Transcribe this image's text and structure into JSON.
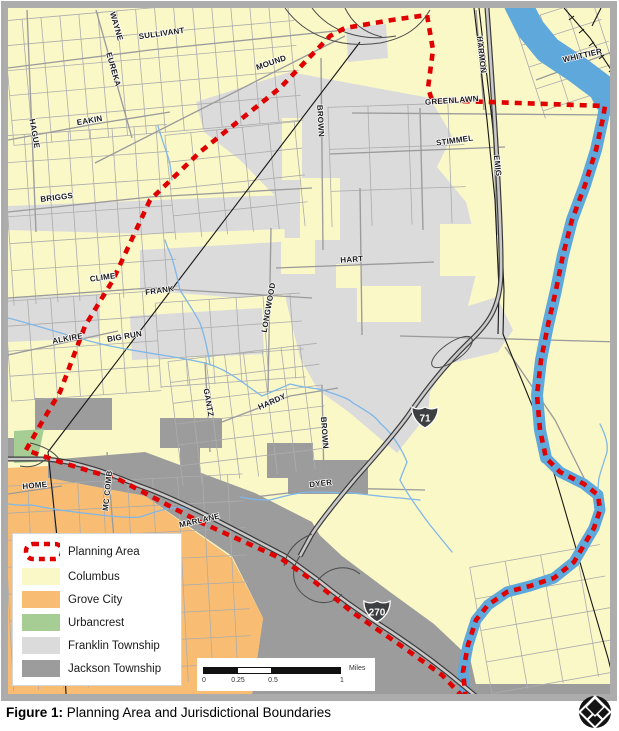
{
  "figure": {
    "label": "Figure 1:",
    "title": "Planning Area and Jurisdictional Boundaries"
  },
  "legend": {
    "items": [
      {
        "label": "Planning Area",
        "swatch": "planning_area"
      },
      {
        "label": "Columbus",
        "swatch": "columbus"
      },
      {
        "label": "Grove City",
        "swatch": "grove_city"
      },
      {
        "label": "Urbancrest",
        "swatch": "urbancrest"
      },
      {
        "label": "Franklin Township",
        "swatch": "franklin_township"
      },
      {
        "label": "Jackson Township",
        "swatch": "jackson_township"
      }
    ]
  },
  "scalebar": {
    "tick0": "0",
    "tick1": "0.25",
    "tick2": "0.5",
    "tick3": "1",
    "unit": "Miles"
  },
  "highways": [
    {
      "route": "71",
      "x": 425,
      "y": 417
    },
    {
      "route": "270",
      "x": 377,
      "y": 611
    }
  ],
  "map": {
    "street_labels": [
      {
        "text": "WAYNE",
        "x": 114,
        "y": 27,
        "rot": 74
      },
      {
        "text": "SULLIVANT",
        "x": 162,
        "y": 36,
        "rot": -8
      },
      {
        "text": "EUREKA",
        "x": 111,
        "y": 70,
        "rot": 74
      },
      {
        "text": "MOUND",
        "x": 272,
        "y": 65,
        "rot": -19
      },
      {
        "text": "HAGUE",
        "x": 32,
        "y": 134,
        "rot": 80
      },
      {
        "text": "EAKIN",
        "x": 90,
        "y": 123,
        "rot": -10
      },
      {
        "text": "BRIGGS",
        "x": 57,
        "y": 200,
        "rot": -7
      },
      {
        "text": "BROWN",
        "x": 318,
        "y": 121,
        "rot": 87
      },
      {
        "text": "HARMON",
        "x": 479,
        "y": 55,
        "rot": 84
      },
      {
        "text": "WHITTIER",
        "x": 583,
        "y": 58,
        "rot": -13
      },
      {
        "text": "GREENLAWN",
        "x": 452,
        "y": 103,
        "rot": -4
      },
      {
        "text": "STIMMEL",
        "x": 455,
        "y": 143,
        "rot": -8
      },
      {
        "text": "EMIG",
        "x": 495,
        "y": 166,
        "rot": 84
      },
      {
        "text": "HART",
        "x": 352,
        "y": 262,
        "rot": -4
      },
      {
        "text": "CLIME",
        "x": 103,
        "y": 280,
        "rot": -8
      },
      {
        "text": "FRANK",
        "x": 160,
        "y": 293,
        "rot": -8
      },
      {
        "text": "LONGWOOD",
        "x": 271,
        "y": 308,
        "rot": -80
      },
      {
        "text": "ALKIRE",
        "x": 68,
        "y": 341,
        "rot": -10
      },
      {
        "text": "BIG RUN",
        "x": 125,
        "y": 339,
        "rot": -10
      },
      {
        "text": "GANTZ",
        "x": 206,
        "y": 403,
        "rot": 80
      },
      {
        "text": "HARDY",
        "x": 273,
        "y": 404,
        "rot": -24
      },
      {
        "text": "BROWN",
        "x": 322,
        "y": 433,
        "rot": 86
      },
      {
        "text": "DYER",
        "x": 321,
        "y": 486,
        "rot": -7
      },
      {
        "text": "HOME",
        "x": 35,
        "y": 488,
        "rot": -5
      },
      {
        "text": "MC COMB",
        "x": 110,
        "y": 491,
        "rot": -84
      },
      {
        "text": "MARLANE",
        "x": 200,
        "y": 523,
        "rot": -13
      }
    ]
  },
  "colors": {
    "planning_area": "#E00000",
    "columbus": "#FBF8C8",
    "grove_city": "#F8BD72",
    "urbancrest": "#A5CD94",
    "franklin_township": "#DBDBDB",
    "jackson_township": "#9C9C9C",
    "water": "#5FA8DC",
    "stream": "#7FB7E8",
    "frame": "#ACACAC"
  }
}
